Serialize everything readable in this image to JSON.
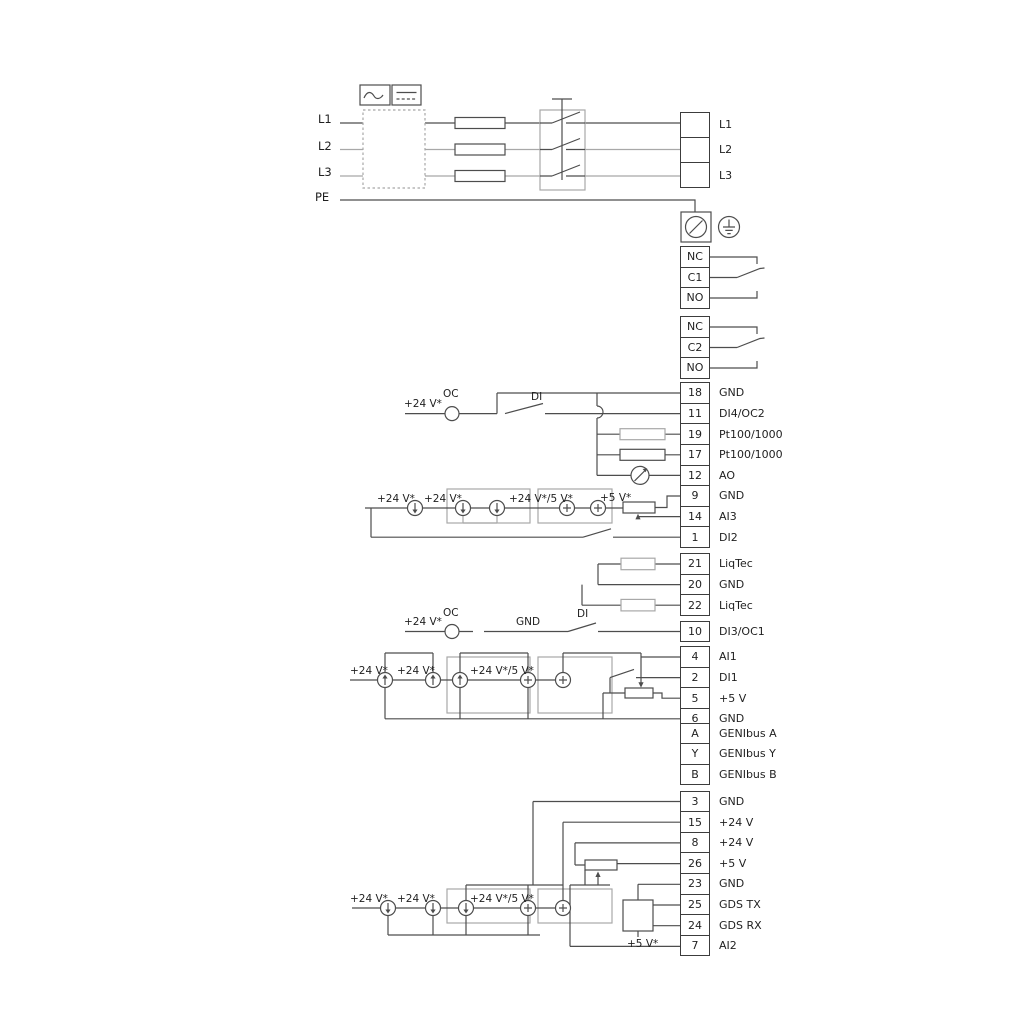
{
  "power": {
    "inputs": [
      "L1",
      "L2",
      "L3",
      "PE"
    ],
    "outputs": [
      "L1",
      "L2",
      "L3"
    ]
  },
  "relay1": {
    "cells": [
      "NC",
      "C1",
      "NO"
    ]
  },
  "relay2": {
    "cells": [
      "NC",
      "C2",
      "NO"
    ]
  },
  "io_top": [
    {
      "num": "18",
      "label": "GND"
    },
    {
      "num": "11",
      "label": "DI4/OC2"
    },
    {
      "num": "19",
      "label": "Pt100/1000"
    },
    {
      "num": "17",
      "label": "Pt100/1000"
    },
    {
      "num": "12",
      "label": "AO"
    },
    {
      "num": "9",
      "label": "GND"
    },
    {
      "num": "14",
      "label": "AI3"
    },
    {
      "num": "1",
      "label": "DI2"
    }
  ],
  "io_liqtec": [
    {
      "num": "21",
      "label": "LiqTec"
    },
    {
      "num": "20",
      "label": "GND"
    },
    {
      "num": "22",
      "label": "LiqTec"
    }
  ],
  "io_di3": [
    {
      "num": "10",
      "label": "DI3/OC1"
    }
  ],
  "io_mid": [
    {
      "num": "4",
      "label": "AI1"
    },
    {
      "num": "2",
      "label": "DI1"
    },
    {
      "num": "5",
      "label": "+5 V"
    },
    {
      "num": "6",
      "label": "GND"
    }
  ],
  "io_genibus": [
    {
      "num": "A",
      "label": "GENIbus A"
    },
    {
      "num": "Y",
      "label": "GENIbus Y"
    },
    {
      "num": "B",
      "label": "GENIbus B"
    }
  ],
  "io_bottom": [
    {
      "num": "3",
      "label": "GND"
    },
    {
      "num": "15",
      "label": "+24 V"
    },
    {
      "num": "8",
      "label": "+24 V"
    },
    {
      "num": "26",
      "label": "+5 V"
    },
    {
      "num": "23",
      "label": "GND"
    },
    {
      "num": "25",
      "label": "GDS TX"
    },
    {
      "num": "24",
      "label": "GDS RX"
    },
    {
      "num": "7",
      "label": "AI2"
    }
  ],
  "annotations": {
    "v24": "+24 V*",
    "v245": "+24 V*/5 V*",
    "v5": "+5 V*",
    "oc": "OC",
    "di": "DI",
    "gnd": "GND"
  },
  "colors": {
    "wire_dark": "#4d4d4d",
    "wire_gray": "#a8a8a8"
  }
}
